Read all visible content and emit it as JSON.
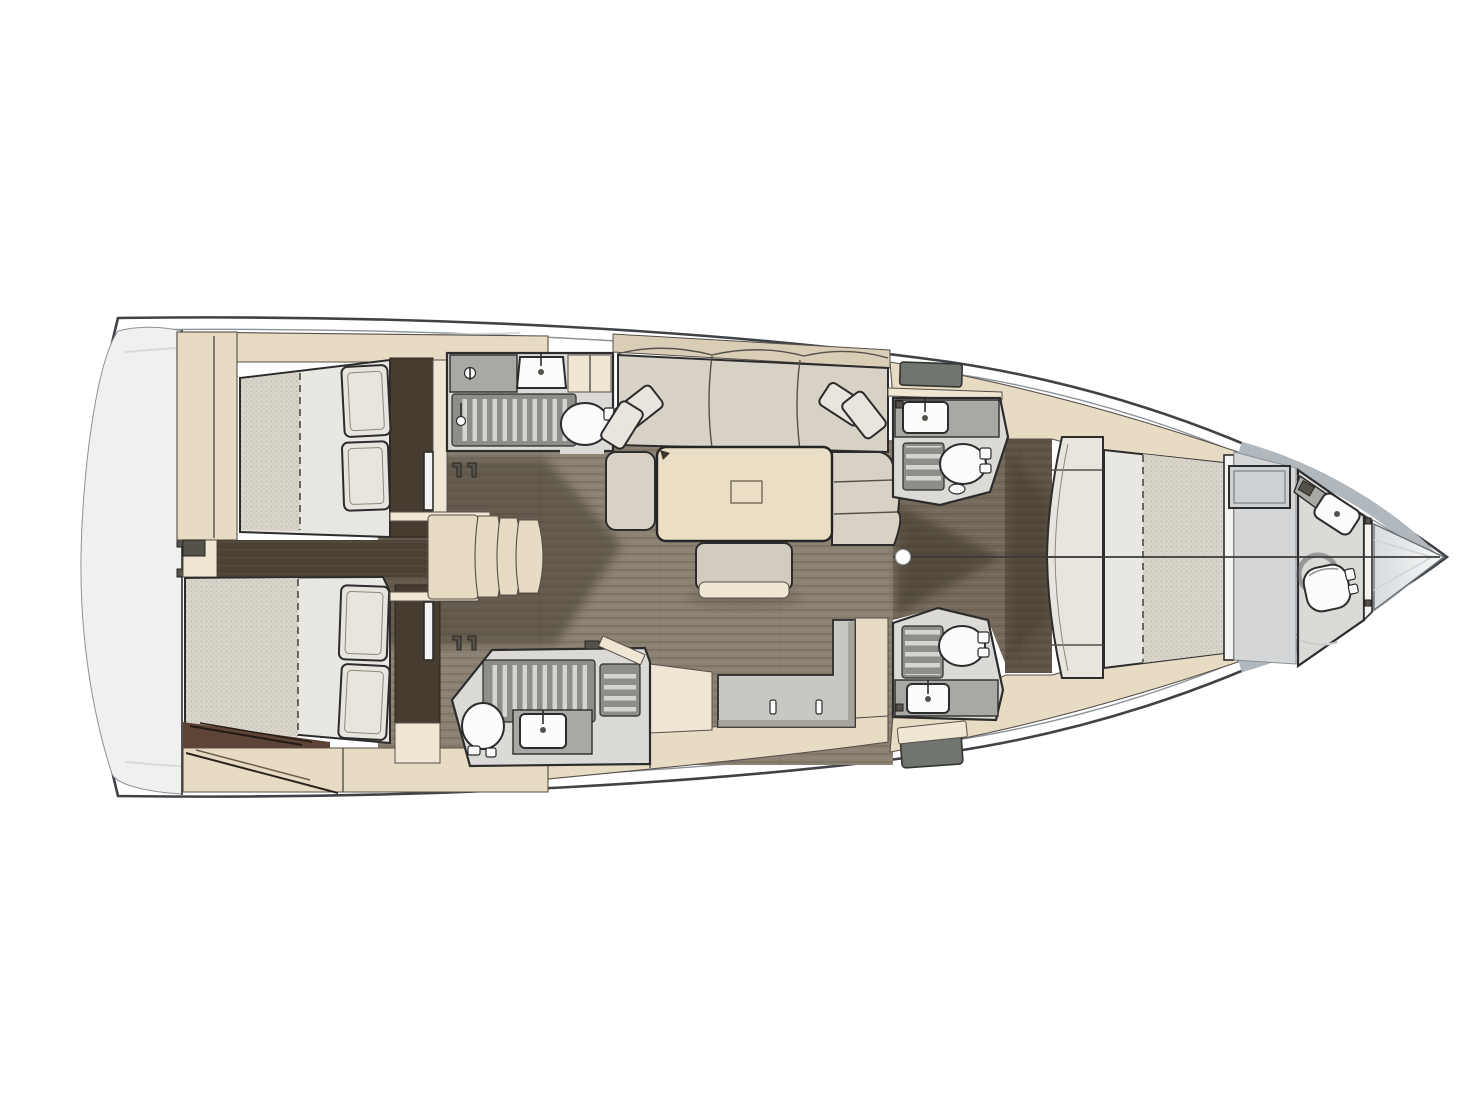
{
  "meta": {
    "description": "Top-down interior layout plan of a sailing yacht, bow pointing right: two aft double cabins, two midship heads with showers, companionway stairs, saloon with L-shaped sofa, table and ottoman, galley counter, two angled forward heads, owner cabin with curved settee and island double berth, forward head and anchor locker in the bow"
  },
  "canvas": {
    "width": 1478,
    "height": 1109,
    "background": "#ffffff"
  },
  "palette": {
    "hull_stroke": "#3f4347",
    "inner_line": "#8d9296",
    "bow_band": "#b0b7bd",
    "platform": "#f0f0f1",
    "platform_line": "#dadadb",
    "beige": "#e7dbc4",
    "beige_light": "#efe6d3",
    "beige_edge": "#57504a",
    "wood": "#8b8173",
    "wood_mid": "#756a5c",
    "wood_walk": "#5e5346",
    "wood_aft": "#4c4134",
    "shadow": "#352d24",
    "panel_dark": "#473c30",
    "maroon": "#5d4437",
    "head_floor": "#dbdad7",
    "counter": "#a9a8a4",
    "counter_light": "#c9c7c1",
    "shower_floor": "#8f8d89",
    "slat": "#d6d4d0",
    "fixture_white": "#fcfcfc",
    "mattress": "#e9e7e2",
    "mattress_tex": "#d9d4ca",
    "pillow": "#e8e5de",
    "sofa": "#d7d1c6",
    "sofa_back": "#d9cdb6",
    "table": "#eadfc5",
    "ottoman": "#d2ccc0",
    "hatch_gray": "#70756f",
    "vanity_gray": "#d4d6d8",
    "locker_light": "#dfe2e4",
    "line_dark": "#2c2c2c",
    "seam": "#54504a"
  },
  "inventory": {
    "double_berths": 3,
    "toilets": 5,
    "sinks": 5,
    "shower_grates": 5,
    "companionway_steps": 4,
    "sofa_throw_pillows": 4,
    "berth_pillows": 4,
    "deck_hatches": 2,
    "mast_posts": 1
  },
  "regions": [
    "swim-platform",
    "aft-cabin-port",
    "aft-cabin-starboard",
    "companionway",
    "head-aft-port",
    "head-aft-starboard",
    "saloon",
    "galley",
    "head-fwd-port",
    "head-fwd-starboard",
    "owner-cabin",
    "bow-head",
    "anchor-locker"
  ]
}
